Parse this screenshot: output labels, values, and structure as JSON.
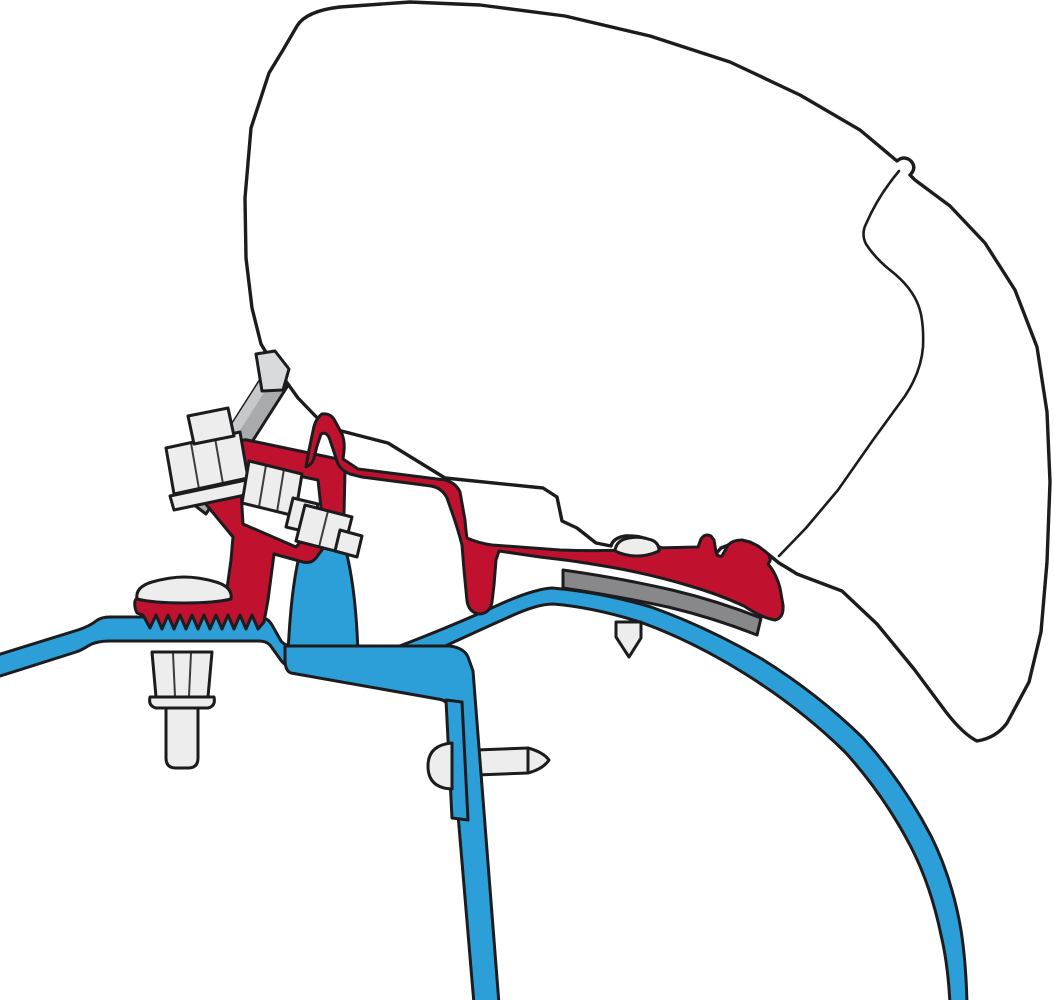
{
  "diagram": {
    "kind": "technical-cross-section",
    "subject": "awning-roof-adapter-bracket-profile"
  },
  "colors": {
    "background": "#ffffff",
    "outline": "#1c1c1e",
    "case_fill": "#ffffff",
    "bracket_red": "#c0122f",
    "roof_blue": "#2d9fd8",
    "pad_gray": "#88888b",
    "plate_gray": "#a8aaac",
    "plate_cap_gray": "#d8dadc",
    "hardware_light": "#ededee"
  },
  "components": {
    "awning_case": "awning-case-outline",
    "case_crease": "case-profile-crease",
    "roof_sheet": "roof-sheet-left",
    "roof_inner_panel": "roof-inner-wall-panel",
    "roof_rib": "roof-rib-mound",
    "roof_skin_arc": "roof-skin-curved",
    "adhesive_pad": "adhesive-pad-strip",
    "clamp": "red-clamp-bracket",
    "rail": "red-adapter-rail",
    "plate": "mounting-plate",
    "bolt_upper": "upper-hex-bolt",
    "bolt_lower": "lower-hex-bolt",
    "dome_screw": "flange-dome-screw",
    "rail_screw": "rail-screw",
    "wall_screw": "wall-screw",
    "nut": "flange-nut-and-stud"
  }
}
